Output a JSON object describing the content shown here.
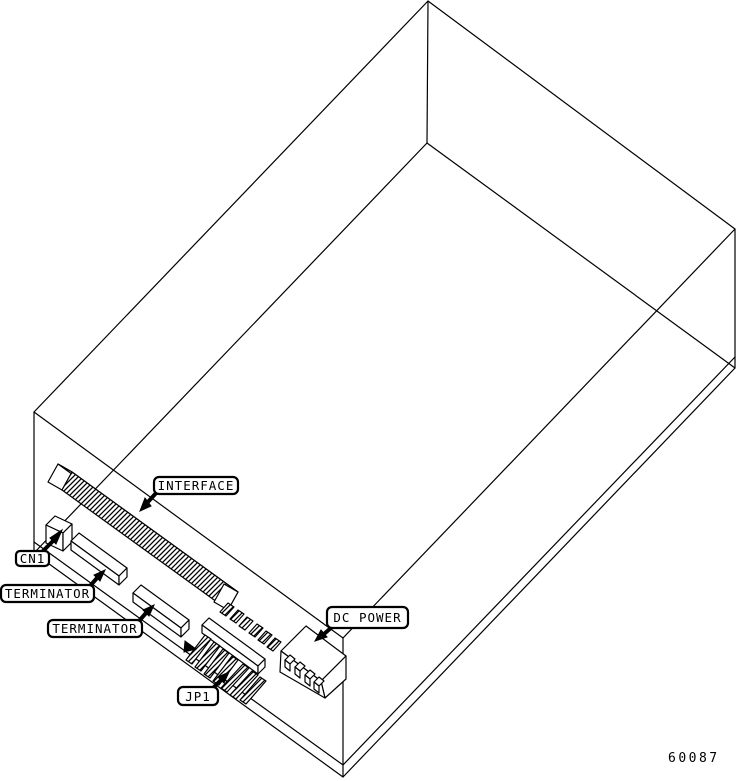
{
  "colors": {
    "background": "#ffffff",
    "line": "#000000",
    "label_fill": "#ffffff",
    "label_text": "#000000"
  },
  "callouts": {
    "interface": "INTERFACE",
    "cn1": "CN1",
    "terminator_top": "TERMINATOR",
    "terminator_bottom": "TERMINATOR",
    "jp1": "JP1",
    "dc_power": "DC POWER"
  },
  "figure_number": "60087"
}
